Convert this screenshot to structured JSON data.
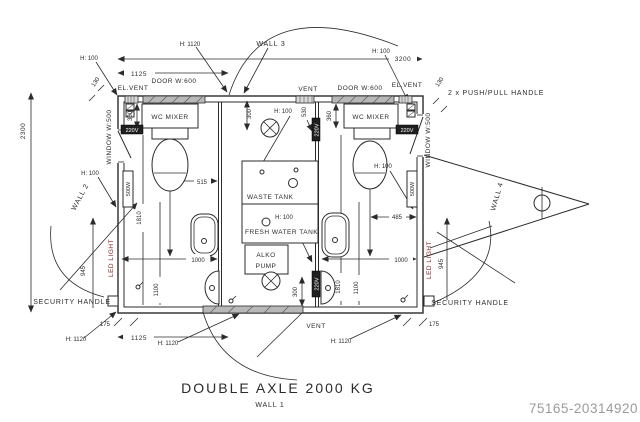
{
  "drawing": {
    "title": "DOUBLE AXLE 2000 KG",
    "watermark": "75165-20314920"
  },
  "walls": {
    "wall1": "WALL 1",
    "wall2": "WALL 2",
    "wall3": "WALL 3",
    "wall4": "WALL 4"
  },
  "labels": {
    "el_vent": "EL.VENT",
    "vent": "VENT",
    "door": "DOOR W:600",
    "window": "WINDOW W:500",
    "wc_mixer": "WC MIXER",
    "waste_tank": "WASTE TANK",
    "fresh_water_tank": "FRESH WATER TANK",
    "alko1": "ALKO",
    "alko2": "PUMP",
    "led_light": "LED LIGHT",
    "security_handle": "SECURITY HANDLE",
    "push_pull_handle": "2 x PUSH/PULL HANDLE",
    "heater": "500W",
    "power": "220V",
    "h100": "H: 100",
    "h1120": "H: 1120"
  },
  "dims": {
    "d3200": "3200",
    "d2300": "2300",
    "d1125": "1125",
    "d130": "130",
    "d360": "360",
    "d515": "515",
    "d485": "485",
    "d1000": "1000",
    "d945": "945",
    "d1810": "1810",
    "d1100": "1100",
    "d300": "300",
    "d530": "530",
    "d175": "175"
  },
  "colors": {
    "line": "#2b2b2b",
    "led_text": "#8a2020",
    "door_fill": "#b8b8b8",
    "watermark": "#9b9b9b"
  }
}
